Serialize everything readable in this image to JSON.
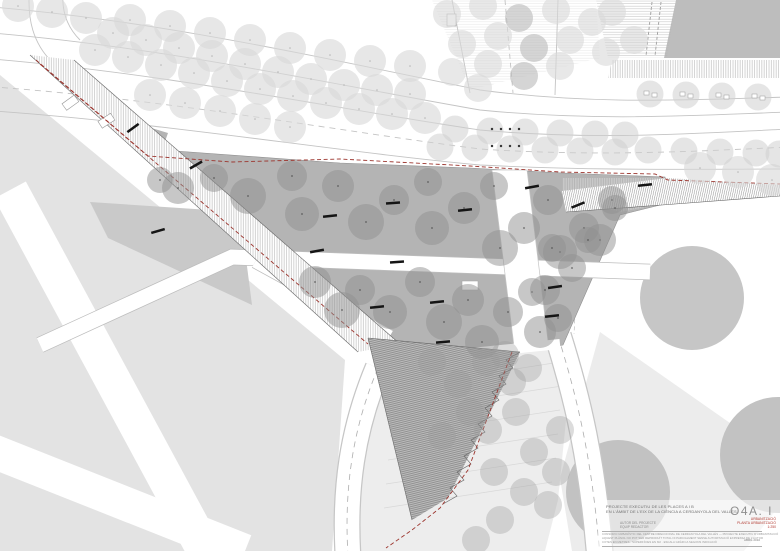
{
  "title_block": {
    "project_line1": "PROJECTE EXECUTIU DE LES PLACES A I B",
    "project_line2": "EN L'ÀMBIT DE L'EIX DE LA CIÈNCIA A CERDANYOLA DEL VALLÈS",
    "credit_line1": "AUTOR DEL PROJECTE",
    "credit_line2": "EQUIP REDACTOR",
    "note_line1": "CONSORCI URBANÍSTIC DEL CENTRE DIRECCIONAL DE CERDANYOLA DEL VALLÈS — PROJECTE EXECUTIU D'URBANITZACIÓ",
    "note_line2": "AQUEST PLÀNOL NO POT SER REPRODUÏT TOTAL NI PARCIALMENT SENSE AUTORITZACIÓ EXPRESSA DE L'AUTOR",
    "note_line3": "COTES EN METRES · SUPERFÍCIES EN M2 · ESCALA GRÀFICA SEGONS INDICACIÓ",
    "sheet_code": "O4A. I",
    "discipline": "URBANITZACIÓ",
    "sheet_title": "PLANTA URBANITZACIÓ",
    "scale": "1:250",
    "date": "ABRIL 2010"
  },
  "palette": {
    "boundary_red": "#9c352e",
    "plaza_gray": "#b4b4b4",
    "plaza_tree": "#8f8f8f",
    "light_tree": "#d9d9d9",
    "median_tree": "#cfcfcf",
    "terrace_tree": "#9a9a9a",
    "parcel_gray": "#e3e3e3",
    "block_gray": "#c2c2c2",
    "bench_black": "#151515",
    "edge_gray": "#c4c4c4"
  },
  "plan": {
    "boulevard_trees": [
      [
        95,
        50
      ],
      [
        128,
        57
      ],
      [
        161,
        65
      ],
      [
        194,
        73
      ],
      [
        227,
        81
      ],
      [
        260,
        89
      ],
      [
        293,
        96
      ],
      [
        326,
        103
      ],
      [
        359,
        109
      ],
      [
        392,
        114
      ],
      [
        425,
        118
      ],
      [
        113,
        33
      ],
      [
        146,
        40
      ],
      [
        179,
        48
      ],
      [
        212,
        56
      ],
      [
        245,
        64
      ],
      [
        278,
        72
      ],
      [
        311,
        79
      ],
      [
        344,
        85
      ],
      [
        377,
        90
      ],
      [
        410,
        94
      ],
      [
        130,
        20
      ],
      [
        170,
        26
      ],
      [
        210,
        33
      ],
      [
        250,
        40
      ],
      [
        290,
        48
      ],
      [
        330,
        55
      ],
      [
        370,
        61
      ],
      [
        410,
        66
      ],
      [
        150,
        95
      ],
      [
        185,
        103
      ],
      [
        220,
        111
      ],
      [
        255,
        119
      ],
      [
        290,
        127
      ],
      [
        18,
        6
      ],
      [
        52,
        12
      ],
      [
        86,
        18
      ],
      [
        700,
        168
      ],
      [
        738,
        172
      ],
      [
        772,
        180
      ]
    ],
    "median_trees": [
      [
        455,
        129
      ],
      [
        490,
        131
      ],
      [
        525,
        132
      ],
      [
        560,
        133
      ],
      [
        595,
        134
      ],
      [
        625,
        135
      ],
      [
        440,
        147
      ],
      [
        475,
        148
      ],
      [
        510,
        149
      ],
      [
        545,
        150
      ],
      [
        580,
        151
      ],
      [
        615,
        152
      ],
      [
        648,
        150
      ],
      [
        684,
        151
      ],
      [
        720,
        152
      ],
      [
        756,
        153
      ],
      [
        779,
        154
      ],
      [
        650,
        94
      ],
      [
        686,
        95
      ],
      [
        722,
        96
      ],
      [
        758,
        97
      ]
    ],
    "top_plaza_trees": [
      [
        447,
        14
      ],
      [
        483,
        6
      ],
      [
        519,
        18
      ],
      [
        556,
        10
      ],
      [
        592,
        22
      ],
      [
        462,
        44
      ],
      [
        498,
        36
      ],
      [
        534,
        48
      ],
      [
        570,
        40
      ],
      [
        606,
        52
      ],
      [
        452,
        72
      ],
      [
        488,
        64
      ],
      [
        524,
        76
      ],
      [
        560,
        66
      ],
      [
        478,
        88
      ],
      [
        612,
        12
      ],
      [
        634,
        40
      ]
    ],
    "plaza_trees": [
      [
        178,
        188,
        16
      ],
      [
        214,
        178,
        14
      ],
      [
        248,
        196,
        18
      ],
      [
        292,
        176,
        15
      ],
      [
        302,
        214,
        17
      ],
      [
        338,
        186,
        16
      ],
      [
        366,
        222,
        18
      ],
      [
        394,
        200,
        15
      ],
      [
        428,
        182,
        14
      ],
      [
        432,
        228,
        17
      ],
      [
        464,
        208,
        16
      ],
      [
        494,
        186,
        14
      ],
      [
        500,
        248,
        18
      ],
      [
        524,
        228,
        16
      ],
      [
        548,
        200,
        15
      ],
      [
        560,
        252,
        17
      ],
      [
        584,
        228,
        15
      ],
      [
        612,
        200,
        14
      ],
      [
        600,
        240,
        16
      ],
      [
        615,
        208,
        13
      ],
      [
        160,
        180,
        13
      ],
      [
        315,
        282,
        16
      ],
      [
        342,
        310,
        18
      ],
      [
        360,
        290,
        15
      ],
      [
        390,
        312,
        17
      ],
      [
        420,
        282,
        15
      ],
      [
        444,
        322,
        18
      ],
      [
        468,
        300,
        16
      ],
      [
        482,
        342,
        17
      ],
      [
        508,
        312,
        15
      ],
      [
        532,
        292,
        14
      ],
      [
        540,
        332,
        16
      ],
      [
        552,
        248,
        14
      ],
      [
        545,
        290,
        15
      ],
      [
        558,
        318,
        14
      ],
      [
        572,
        268,
        14
      ],
      [
        588,
        240,
        13
      ]
    ],
    "terrace_trees": [
      [
        432,
        362
      ],
      [
        458,
        384
      ],
      [
        486,
        362
      ],
      [
        512,
        382
      ],
      [
        470,
        412
      ],
      [
        442,
        436
      ],
      [
        488,
        430
      ],
      [
        516,
        412
      ],
      [
        534,
        452
      ],
      [
        494,
        472
      ],
      [
        524,
        492
      ],
      [
        556,
        472
      ],
      [
        548,
        505
      ],
      [
        500,
        520
      ],
      [
        476,
        540
      ],
      [
        560,
        430
      ],
      [
        505,
        355
      ],
      [
        528,
        368
      ]
    ],
    "benches": [
      [
        133,
        128,
        -36
      ],
      [
        196,
        165,
        -30
      ],
      [
        158,
        231,
        -16
      ],
      [
        330,
        216,
        -6
      ],
      [
        393,
        203,
        -4
      ],
      [
        465,
        210,
        -6
      ],
      [
        317,
        251,
        -10
      ],
      [
        397,
        262,
        -4
      ],
      [
        437,
        302,
        -6
      ],
      [
        377,
        307,
        -6
      ],
      [
        532,
        187,
        -10
      ],
      [
        645,
        185,
        -6
      ],
      [
        578,
        205,
        -22
      ],
      [
        555,
        287,
        -8
      ],
      [
        552,
        316,
        -6
      ],
      [
        443,
        342,
        -5
      ]
    ],
    "tree_grates": [
      [
        650,
        94
      ],
      [
        686,
        95
      ],
      [
        722,
        96
      ],
      [
        758,
        97
      ]
    ],
    "crosswalk_dots": [
      [
        492,
        129
      ],
      [
        501,
        129
      ],
      [
        510,
        129
      ],
      [
        519,
        129
      ],
      [
        492,
        146
      ],
      [
        501,
        146
      ],
      [
        510,
        146
      ],
      [
        519,
        146
      ]
    ]
  }
}
